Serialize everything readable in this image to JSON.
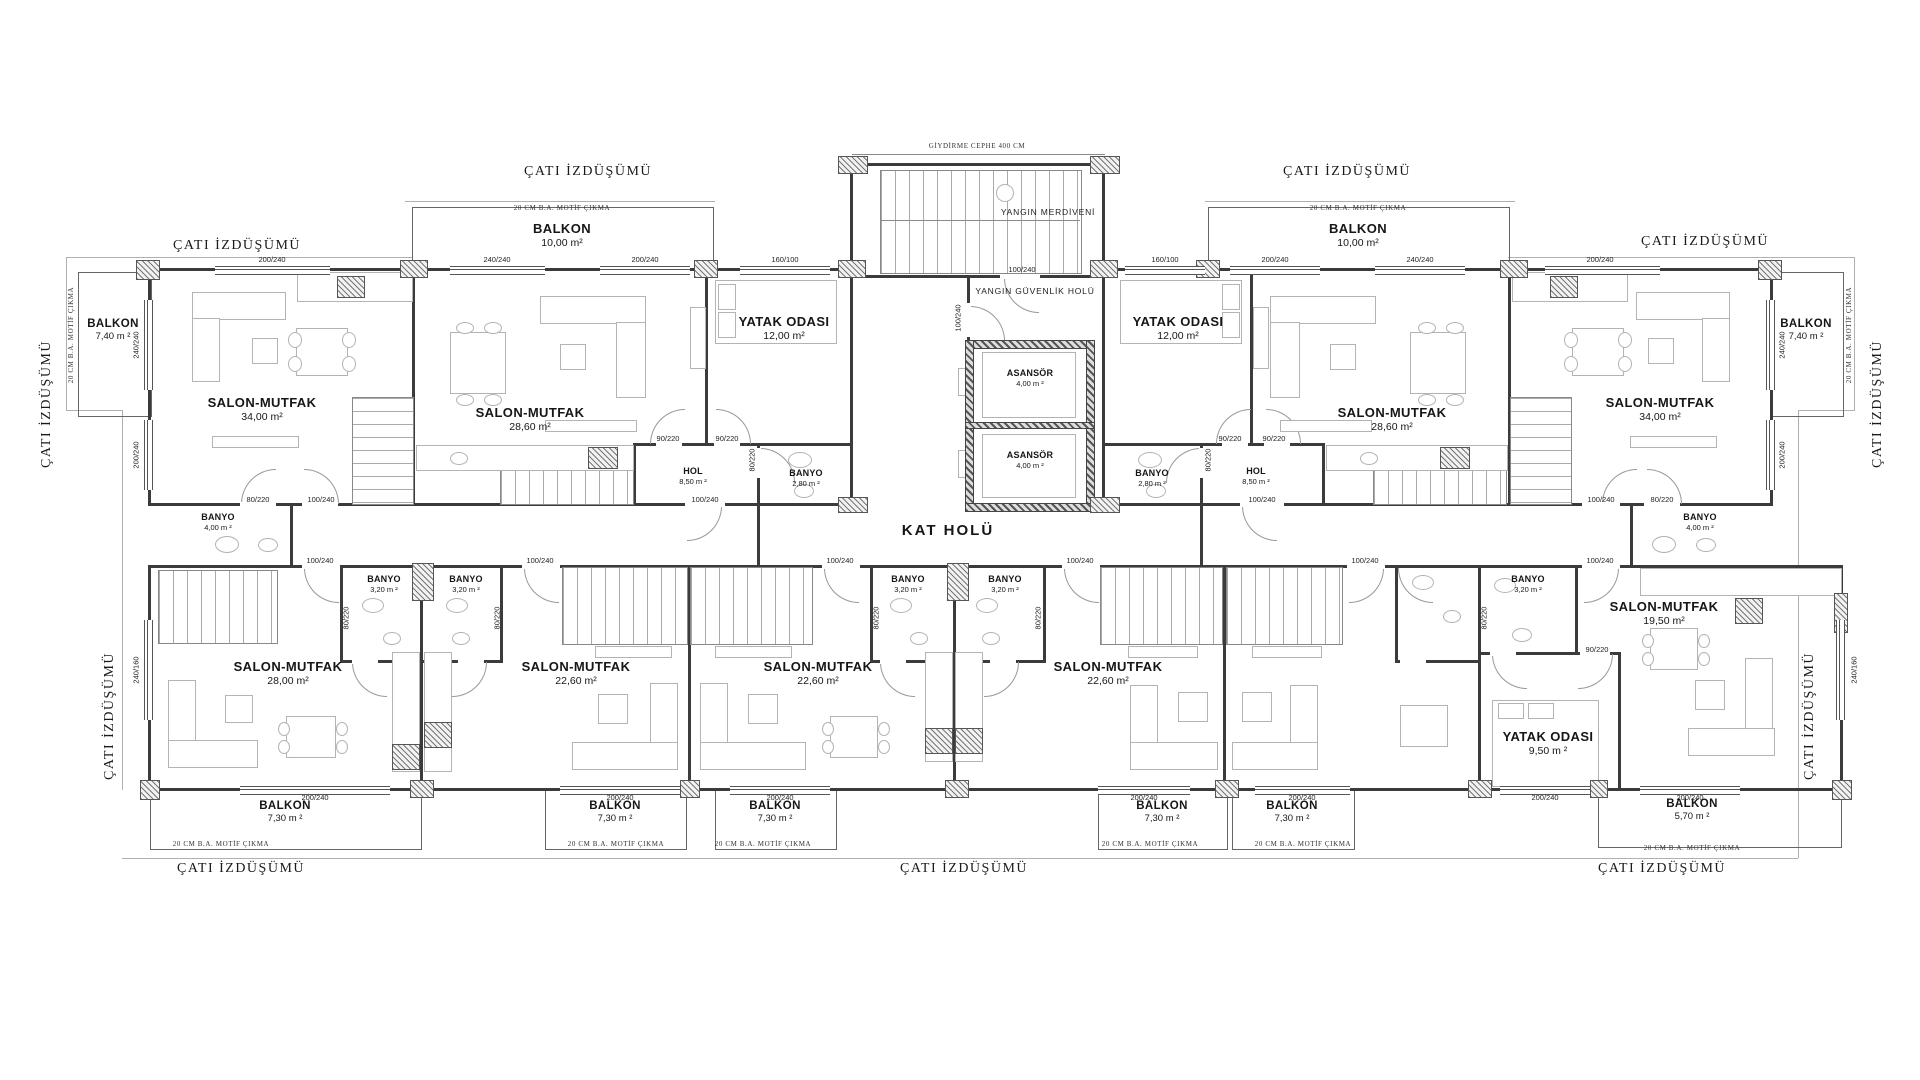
{
  "roof": {
    "label": "ÇATI İZDÜŞÜMÜ",
    "motif": "20 CM B.A. MOTİF ÇIKMA",
    "cephe": "GİYDİRME CEPHE 400 CM"
  },
  "core": {
    "fire_stair": "YANGIN MERDİVENİ",
    "fire_hall": "YANGIN GÜVENLİK HOLÜ",
    "corridor": "KAT HOLÜ",
    "elevator": {
      "name": "ASANSÖR",
      "area": "4,00 m ²"
    }
  },
  "rooms": {
    "balkon_740": {
      "name": "BALKON",
      "area": "7,40 m ²"
    },
    "balkon_10": {
      "name": "BALKON",
      "area": "10,00 m²"
    },
    "balkon_730": {
      "name": "BALKON",
      "area": "7,30 m ²"
    },
    "balkon_570": {
      "name": "BALKON",
      "area": "5,70 m ²"
    },
    "salon_34": {
      "name": "SALON-MUTFAK",
      "area": "34,00 m²"
    },
    "salon_286": {
      "name": "SALON-MUTFAK",
      "area": "28,60 m²"
    },
    "salon_28": {
      "name": "SALON-MUTFAK",
      "area": "28,00 m²"
    },
    "salon_226": {
      "name": "SALON-MUTFAK",
      "area": "22,60 m²"
    },
    "salon_195": {
      "name": "SALON-MUTFAK",
      "area": "19,50 m²"
    },
    "yatak_12": {
      "name": "YATAK ODASI",
      "area": "12,00 m²"
    },
    "yatak_95": {
      "name": "YATAK ODASI",
      "area": "9,50 m ²"
    },
    "hol_85": {
      "name": "HOL",
      "area": "8,50 m ²"
    },
    "banyo_28": {
      "name": "BANYO",
      "area": "2,80 m ²"
    },
    "banyo_40": {
      "name": "BANYO",
      "area": "4,00 m ²"
    },
    "banyo_32": {
      "name": "BANYO",
      "area": "3,20 m ²"
    }
  },
  "dims": {
    "w200": "200/240",
    "w240": "240/240",
    "w160": "160/100",
    "d100": "100/240",
    "d90": "90/220",
    "d80": "80/220",
    "w240160": "240/160"
  }
}
